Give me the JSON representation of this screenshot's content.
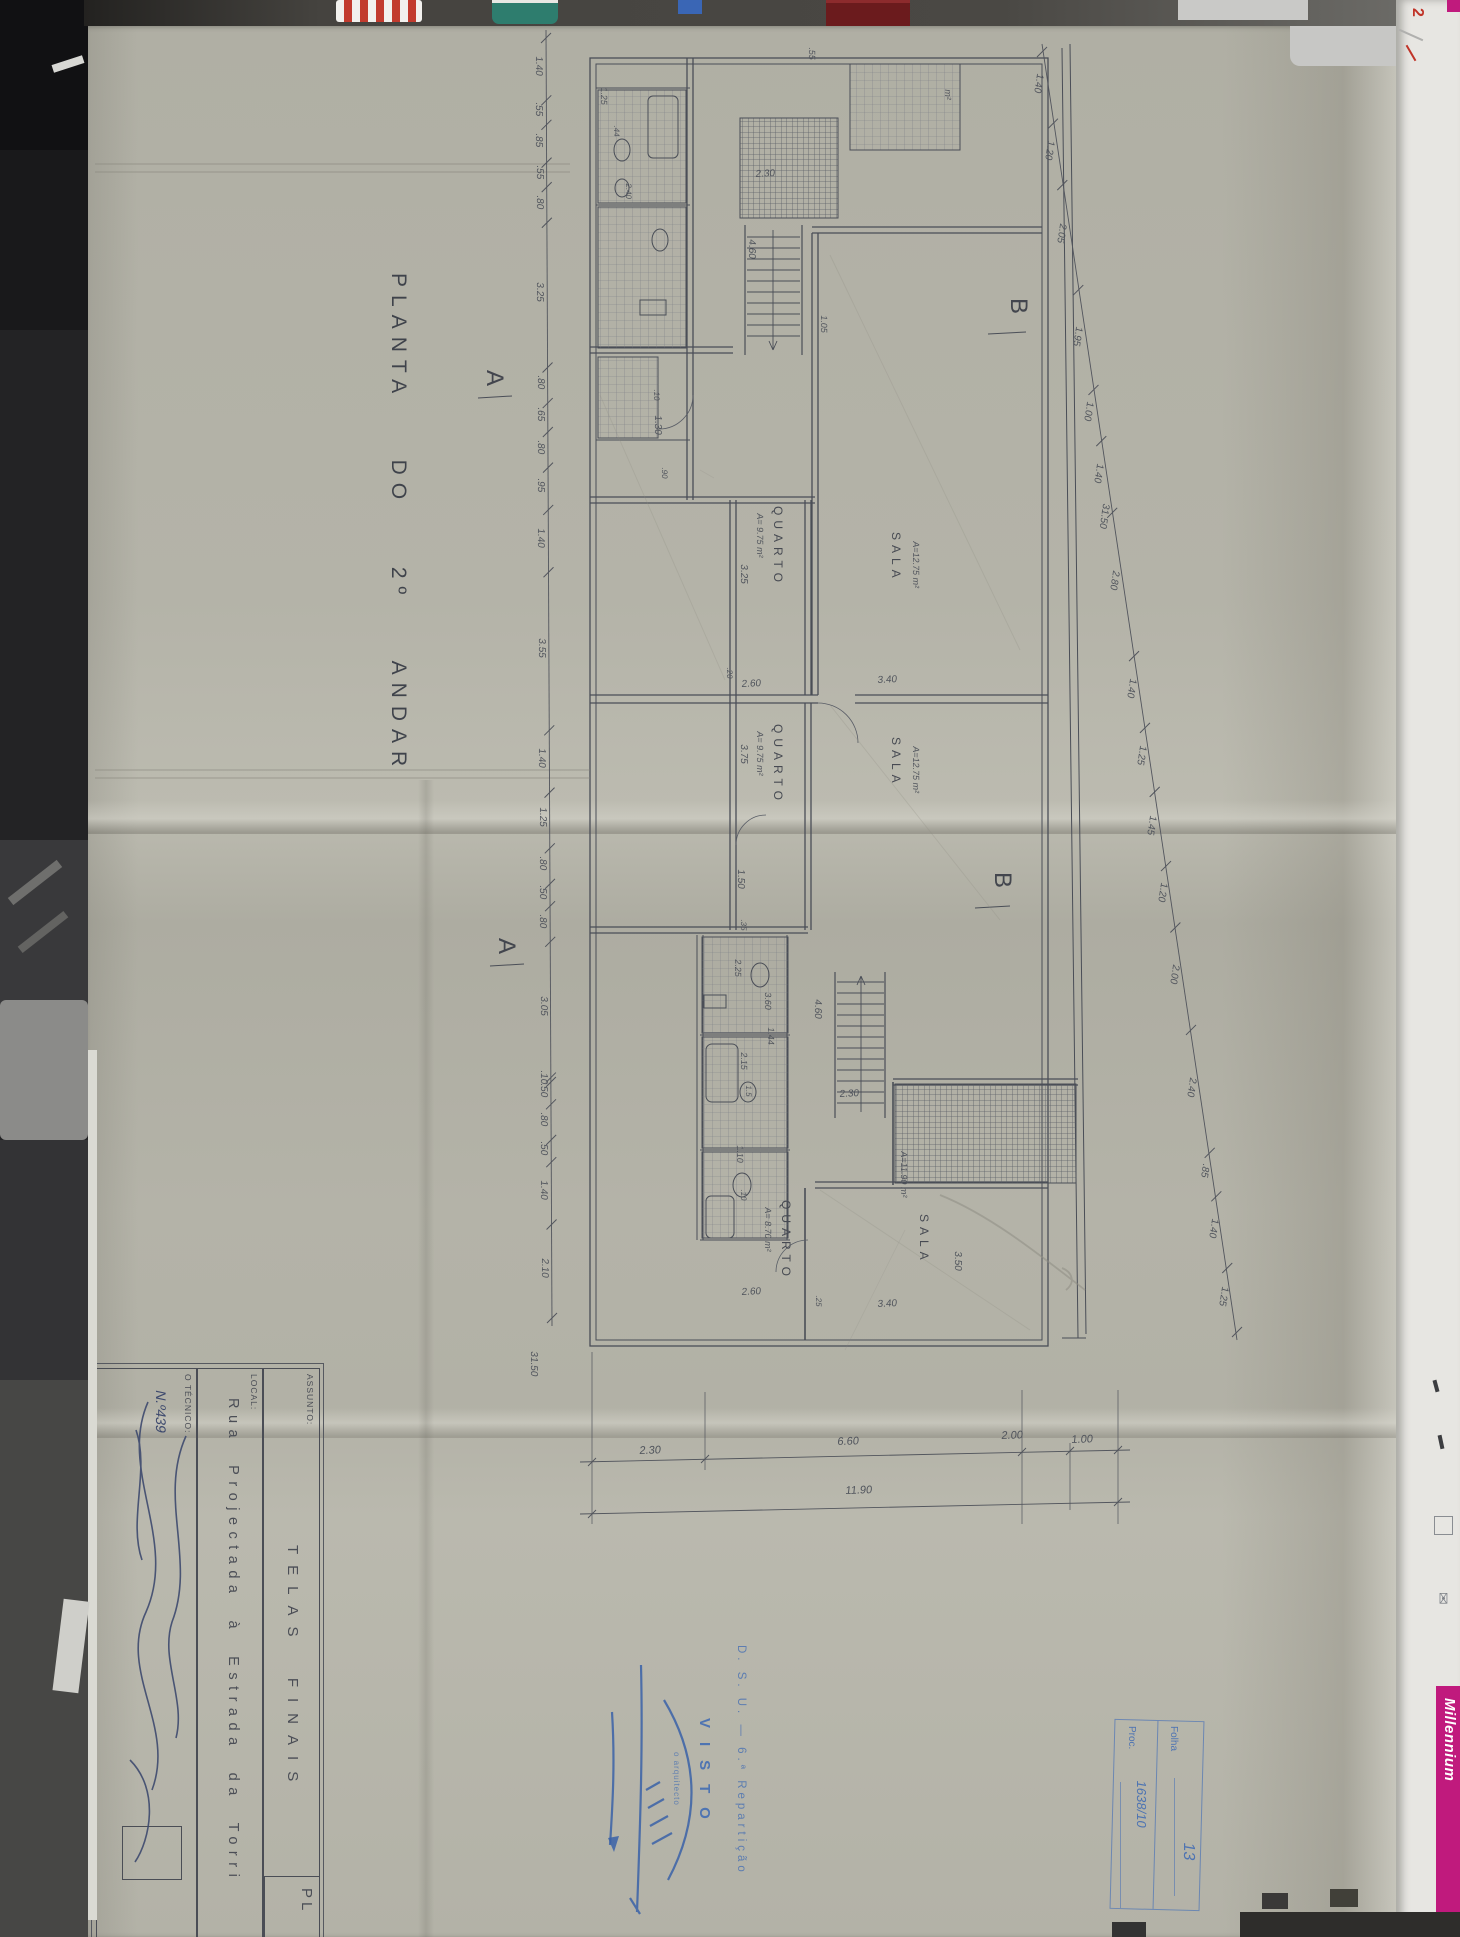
{
  "sheet": {
    "title": "PLANTA  DO  2º  ANDAR",
    "title_block": {
      "assunto_label": "ASSUNTO:",
      "assunto_value": "TELAS  FINAIS",
      "local_label": "LOCAL:",
      "local_value": "Rua  Projectada  à  Estrada  da  Torri",
      "tecnico_label": "O TÉCNICO:",
      "tecnico_number": "N.º439",
      "plate_code": "PL"
    },
    "visto_stamp": {
      "department": "D. S. U. — 6.ª Repartição",
      "visto": "VISTO",
      "role": "o arquitecto"
    },
    "folha_box": {
      "folha_label": "Folha",
      "folha_value": "13",
      "proc_label": "Proc.",
      "proc_value": "1638/10"
    }
  },
  "photo": {
    "millennium": "Millennium",
    "desk_note_number": "2",
    "envelope_icon": "✉"
  },
  "plan": {
    "chains": {
      "left": {
        "x1": 546,
        "y1": 38,
        "x2": 552,
        "y2": 1318,
        "values": [
          "1.40",
          ".55",
          ".85",
          ".55",
          ".80",
          "3.25",
          ".80",
          ".65",
          ".80",
          ".95",
          "1.40",
          "3.55",
          "1.40",
          "1.25",
          ".80",
          ".50",
          ".80",
          "3.05",
          ".10",
          ".50",
          ".80",
          ".50",
          "1.40",
          "2.10"
        ]
      },
      "right": {
        "x1": 1042,
        "y1": 52,
        "x2": 1237,
        "y2": 1332,
        "values": [
          "1.40",
          "1.20",
          "2.05",
          "1.95",
          "1.00",
          "1.40",
          "2.80",
          "1.40",
          "1.25",
          "1.45",
          "1.20",
          "2.00",
          "2.40",
          ".85",
          "1.40",
          "1.25"
        ]
      }
    },
    "labels": [
      {
        "t": "B",
        "x": 1030,
        "y": 298,
        "r": 90,
        "s": 24,
        "c": "sec"
      },
      {
        "t": "B",
        "x": 1014,
        "y": 872,
        "r": 90,
        "s": 24,
        "c": "sec"
      },
      {
        "t": "A",
        "x": 506,
        "y": 370,
        "r": 90,
        "s": 24,
        "c": "sec"
      },
      {
        "t": "A",
        "x": 518,
        "y": 938,
        "r": 90,
        "s": 24,
        "c": "sec"
      },
      {
        "t": "QUARTO",
        "x": 784,
        "y": 506,
        "r": 90,
        "s": 12,
        "c": "room"
      },
      {
        "t": "A= 9.75 m²",
        "x": 764,
        "y": 514,
        "r": 90,
        "s": 9,
        "c": "hand"
      },
      {
        "t": "SALA",
        "x": 902,
        "y": 532,
        "r": 90,
        "s": 12,
        "c": "room"
      },
      {
        "t": "A=12.75 m²",
        "x": 920,
        "y": 542,
        "r": 90,
        "s": 9,
        "c": "hand"
      },
      {
        "t": "QUARTO",
        "x": 784,
        "y": 724,
        "r": 90,
        "s": 12,
        "c": "room"
      },
      {
        "t": "A= 9.75 m²",
        "x": 764,
        "y": 732,
        "r": 90,
        "s": 9,
        "c": "hand"
      },
      {
        "t": "SALA",
        "x": 902,
        "y": 737,
        "r": 90,
        "s": 12,
        "c": "room"
      },
      {
        "t": "A=12.75 m²",
        "x": 920,
        "y": 747,
        "r": 90,
        "s": 9,
        "c": "hand"
      },
      {
        "t": "QUARTO",
        "x": 792,
        "y": 1200,
        "r": 90,
        "s": 12,
        "c": "room"
      },
      {
        "t": "A= 8.70 m²",
        "x": 772,
        "y": 1208,
        "r": 90,
        "s": 9,
        "c": "hand"
      },
      {
        "t": "SALA",
        "x": 930,
        "y": 1214,
        "r": 90,
        "s": 12,
        "c": "room"
      },
      {
        "t": "A=11.90 m²",
        "x": 908,
        "y": 1152,
        "r": 90,
        "s": 9,
        "c": "hand"
      },
      {
        "t": "3.25",
        "x": 748,
        "y": 565,
        "r": 90,
        "s": 10,
        "c": "hand"
      },
      {
        "t": "2.60",
        "x": 742,
        "y": 680,
        "r": -3,
        "s": 10,
        "c": "hand"
      },
      {
        "t": "3.40",
        "x": 878,
        "y": 676,
        "r": -3,
        "s": 10,
        "c": "hand"
      },
      {
        "t": ".20",
        "x": 733,
        "y": 668,
        "r": 90,
        "s": 8,
        "c": "hand"
      },
      {
        "t": "3.75",
        "x": 748,
        "y": 745,
        "r": 90,
        "s": 10,
        "c": "hand"
      },
      {
        "t": "1.50",
        "x": 745,
        "y": 870,
        "r": 90,
        "s": 10,
        "c": "hand"
      },
      {
        "t": ".35",
        "x": 747,
        "y": 920,
        "r": 90,
        "s": 8,
        "c": "hand"
      },
      {
        "t": "1.30",
        "x": 662,
        "y": 416,
        "r": 90,
        "s": 10,
        "c": "hand"
      },
      {
        "t": ".90",
        "x": 668,
        "y": 468,
        "r": 90,
        "s": 8,
        "c": "hand"
      },
      {
        "t": ".10",
        "x": 660,
        "y": 390,
        "r": 90,
        "s": 8,
        "c": "hand"
      },
      {
        "t": "2.30",
        "x": 756,
        "y": 170,
        "r": -3,
        "s": 10,
        "c": "hand"
      },
      {
        "t": "4.60",
        "x": 756,
        "y": 240,
        "r": 90,
        "s": 10,
        "c": "hand"
      },
      {
        "t": "4.60",
        "x": 822,
        "y": 1000,
        "r": 90,
        "s": 10,
        "c": "hand"
      },
      {
        "t": "2.30",
        "x": 840,
        "y": 1090,
        "r": -3,
        "s": 10,
        "c": "hand"
      },
      {
        "t": "2.25",
        "x": 742,
        "y": 960,
        "r": 90,
        "s": 9,
        "c": "hand"
      },
      {
        "t": "3.60",
        "x": 772,
        "y": 993,
        "r": 90,
        "s": 9,
        "c": "hand"
      },
      {
        "t": "1.44",
        "x": 775,
        "y": 1028,
        "r": 90,
        "s": 9,
        "c": "hand"
      },
      {
        "t": "2.15",
        "x": 748,
        "y": 1053,
        "r": 90,
        "s": 9,
        "c": "hand"
      },
      {
        "t": "1.5",
        "x": 752,
        "y": 1086,
        "r": 90,
        "s": 8,
        "c": "hand"
      },
      {
        "t": "1.10",
        "x": 744,
        "y": 1146,
        "r": 90,
        "s": 9,
        "c": "hand"
      },
      {
        "t": ".10",
        "x": 747,
        "y": 1190,
        "r": 90,
        "s": 8,
        "c": "hand"
      },
      {
        "t": "2.60",
        "x": 742,
        "y": 1288,
        "r": -3,
        "s": 10,
        "c": "hand"
      },
      {
        "t": "3.40",
        "x": 878,
        "y": 1300,
        "r": -3,
        "s": 10,
        "c": "hand"
      },
      {
        "t": "3.50",
        "x": 962,
        "y": 1252,
        "r": 90,
        "s": 10,
        "c": "hand"
      },
      {
        "t": ".25",
        "x": 822,
        "y": 1296,
        "r": 90,
        "s": 8,
        "c": "hand"
      },
      {
        "t": "1.25",
        "x": 608,
        "y": 88,
        "r": 90,
        "s": 9,
        "c": "hand"
      },
      {
        "t": ".44",
        "x": 620,
        "y": 126,
        "r": 90,
        "s": 8,
        "c": "hand"
      },
      {
        "t": "2.40",
        "x": 632,
        "y": 184,
        "r": 90,
        "s": 8,
        "c": "hand"
      },
      {
        "t": "1.05",
        "x": 828,
        "y": 316,
        "r": 90,
        "s": 9,
        "c": "hand"
      },
      {
        "t": ".55",
        "x": 816,
        "y": 48,
        "r": 90,
        "s": 9,
        "c": "hand"
      },
      {
        "t": "m²",
        "x": 952,
        "y": 90,
        "r": 90,
        "s": 9,
        "c": "hand"
      },
      {
        "t": "2.30",
        "x": 640,
        "y": 1446,
        "r": -2,
        "s": 11,
        "c": "hand"
      },
      {
        "t": "6.60",
        "x": 838,
        "y": 1437,
        "r": -2,
        "s": 11,
        "c": "hand"
      },
      {
        "t": "2.00",
        "x": 1002,
        "y": 1431,
        "r": -2,
        "s": 11,
        "c": "hand"
      },
      {
        "t": "1.00",
        "x": 1072,
        "y": 1435,
        "r": -2,
        "s": 11,
        "c": "hand"
      },
      {
        "t": "11.90",
        "x": 846,
        "y": 1486,
        "r": -2,
        "s": 11,
        "c": "hand"
      },
      {
        "t": "31.50",
        "x": 538,
        "y": 1352,
        "r": 90,
        "s": 10,
        "c": "hand"
      },
      {
        "t": "31.50",
        "x": 1110,
        "y": 505,
        "r": 98,
        "s": 10,
        "c": "hand"
      }
    ]
  }
}
